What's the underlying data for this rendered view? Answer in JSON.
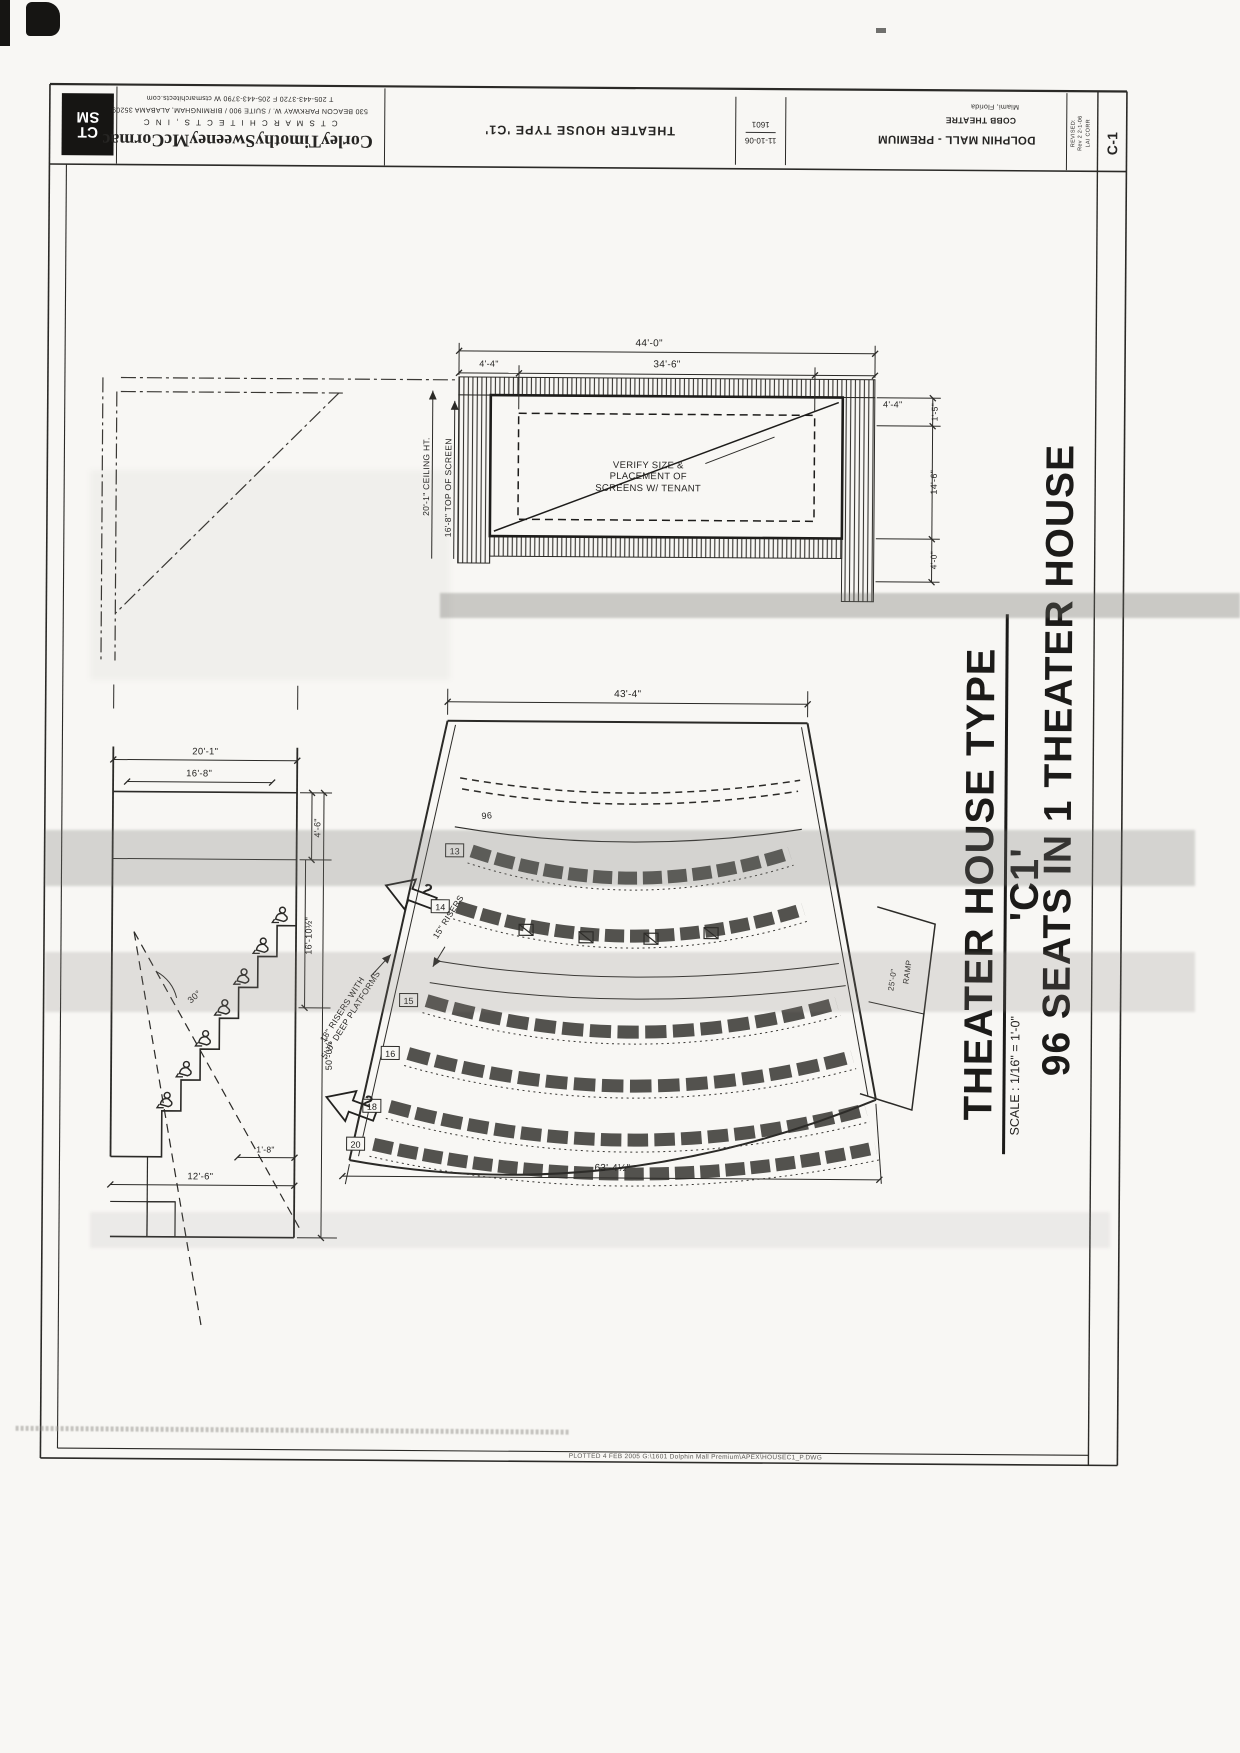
{
  "sheet": {
    "titleblock": {
      "logo_top": "CT",
      "logo_bottom": "SM",
      "firm_name": "CorleyTimothySweeneyMcCormac",
      "firm_type": "C T S M   A R C H I T E C T S ,   I N C",
      "firm_address": "530 BEACON PARKWAY W. / SUITE 900 / BIRMINGHAM, ALABAMA 35209",
      "firm_contact": "T 205-443-3720      F 205-443-3790      W ctsmarchitects.com",
      "sheet_title": "THEATER HOUSE TYPE 'C1'",
      "project_number": "1601",
      "date": "11-10-06",
      "project_name": "DOLPHIN MALL - PREMIUM",
      "client": "COBB THEATRE",
      "location": "Miami, Florida",
      "revision_lines": [
        "REVISED:",
        "Rev 2  2-1-06",
        "LAI CORR"
      ],
      "sheet_number": "C-1"
    },
    "titles": {
      "main": "THEATER HOUSE TYPE 'C1'",
      "seats": "96 SEATS IN 1 THEATER HOUSE",
      "scale": "SCALE : 1/16\" = 1'-0\""
    },
    "screen_detail": {
      "dim_overall": "44'-0\"",
      "dim_left": "4'-4\"",
      "dim_center": "34'-6\"",
      "dim_right": "4'-4\"",
      "dim_r1": "1'-5\"",
      "dim_r2": "14'-6\"",
      "dim_r3": "4'-0\"",
      "ceiling": "20'-1\" CEILING HT.",
      "screen_top": "16'-8\" TOP OF SCREEN",
      "note_line1": "VERIFY SIZE &",
      "note_line2": "PLACEMENT OF",
      "note_line3": "SCREENS W/ TENANT"
    },
    "section": {
      "dim_top1": "20'-1\"",
      "dim_top2": "16'-8\"",
      "dim_a": "4'-6\"",
      "dim_b": "16'-10½\"",
      "dim_c": "50'-0½\"",
      "angle": "30°",
      "dim_bot1": "1'-8\"",
      "dim_bot2": "12'-6\""
    },
    "plan": {
      "dim_top": "43'-4\"",
      "dim_bottom": "63'-4½\"",
      "label_risers": "15\" RISERS",
      "label_platform1": "18\" RISERS WITH",
      "label_platform2": "5'-0\" DEEP PLATFORMS",
      "ramp": "RAMP",
      "ramp_dim": "25'-0\"",
      "total": "96",
      "exit_number": "2",
      "rows": [
        {
          "tag": "13",
          "seats": 13
        },
        {
          "tag": "14",
          "seats": 14
        },
        {
          "tag": "15",
          "seats": 15
        },
        {
          "tag": "16",
          "seats": 16
        },
        {
          "tag": "18",
          "seats": 18
        },
        {
          "tag": "20",
          "seats": 20
        }
      ]
    },
    "footer": {
      "plot_note": "PLOTTED      4 FEB 2005      G:\\1601 Dolphin Mall Premium\\APEX\\HOUSEC1_P.DWG"
    }
  }
}
